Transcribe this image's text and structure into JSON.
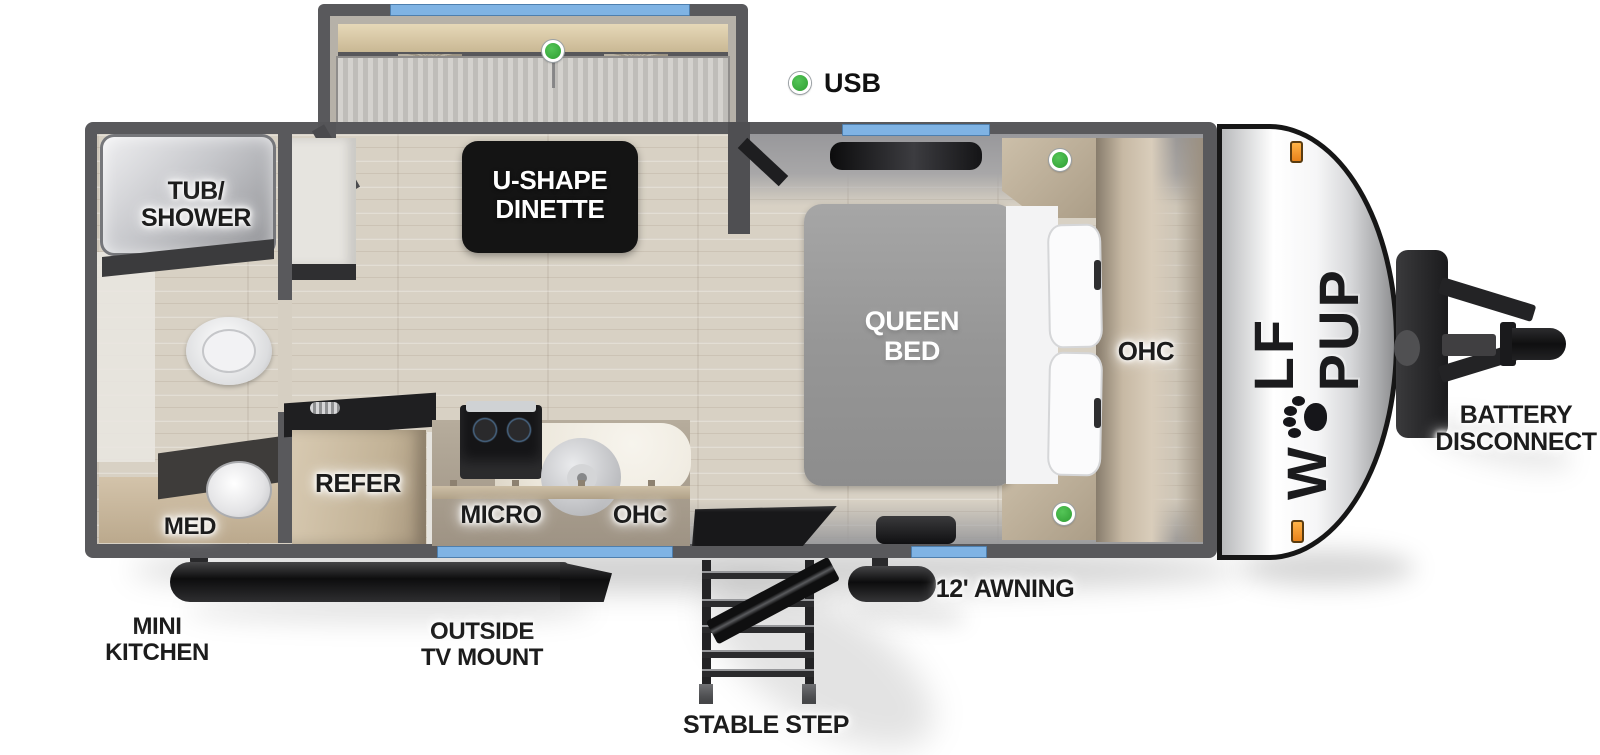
{
  "legend": {
    "usb": "USB"
  },
  "brand": {
    "part1": "W",
    "part2": "LF PUP",
    "name": "WOLF PUP"
  },
  "rooms": {
    "dinette": {
      "line1": "U-SHAPE",
      "line2": "DINETTE"
    },
    "bedroom": {
      "bed_line1": "QUEEN",
      "bed_line2": "BED",
      "ohc": "OHC"
    },
    "bathroom": {
      "tub_line1": "TUB/",
      "tub_line2": "SHOWER",
      "med": "MED"
    },
    "kitchen": {
      "refer": "REFER",
      "micro": "MICRO",
      "ohc": "OHC"
    }
  },
  "exterior": {
    "mini_kitchen_line1": "MINI",
    "mini_kitchen_line2": "KITCHEN",
    "tv_mount_line1": "OUTSIDE",
    "tv_mount_line2": "TV MOUNT",
    "stable_step": "STABLE STEP",
    "awning": "12' AWNING",
    "battery_line1": "BATTERY",
    "battery_line2": "DISCONNECT"
  },
  "colors": {
    "wall": "#59595c",
    "floor": "#d8d1c4",
    "window": "#7fb3e4",
    "usb_indicator": "#3db349",
    "marker_light": "#f6a02a",
    "trim_black": "#161616"
  }
}
